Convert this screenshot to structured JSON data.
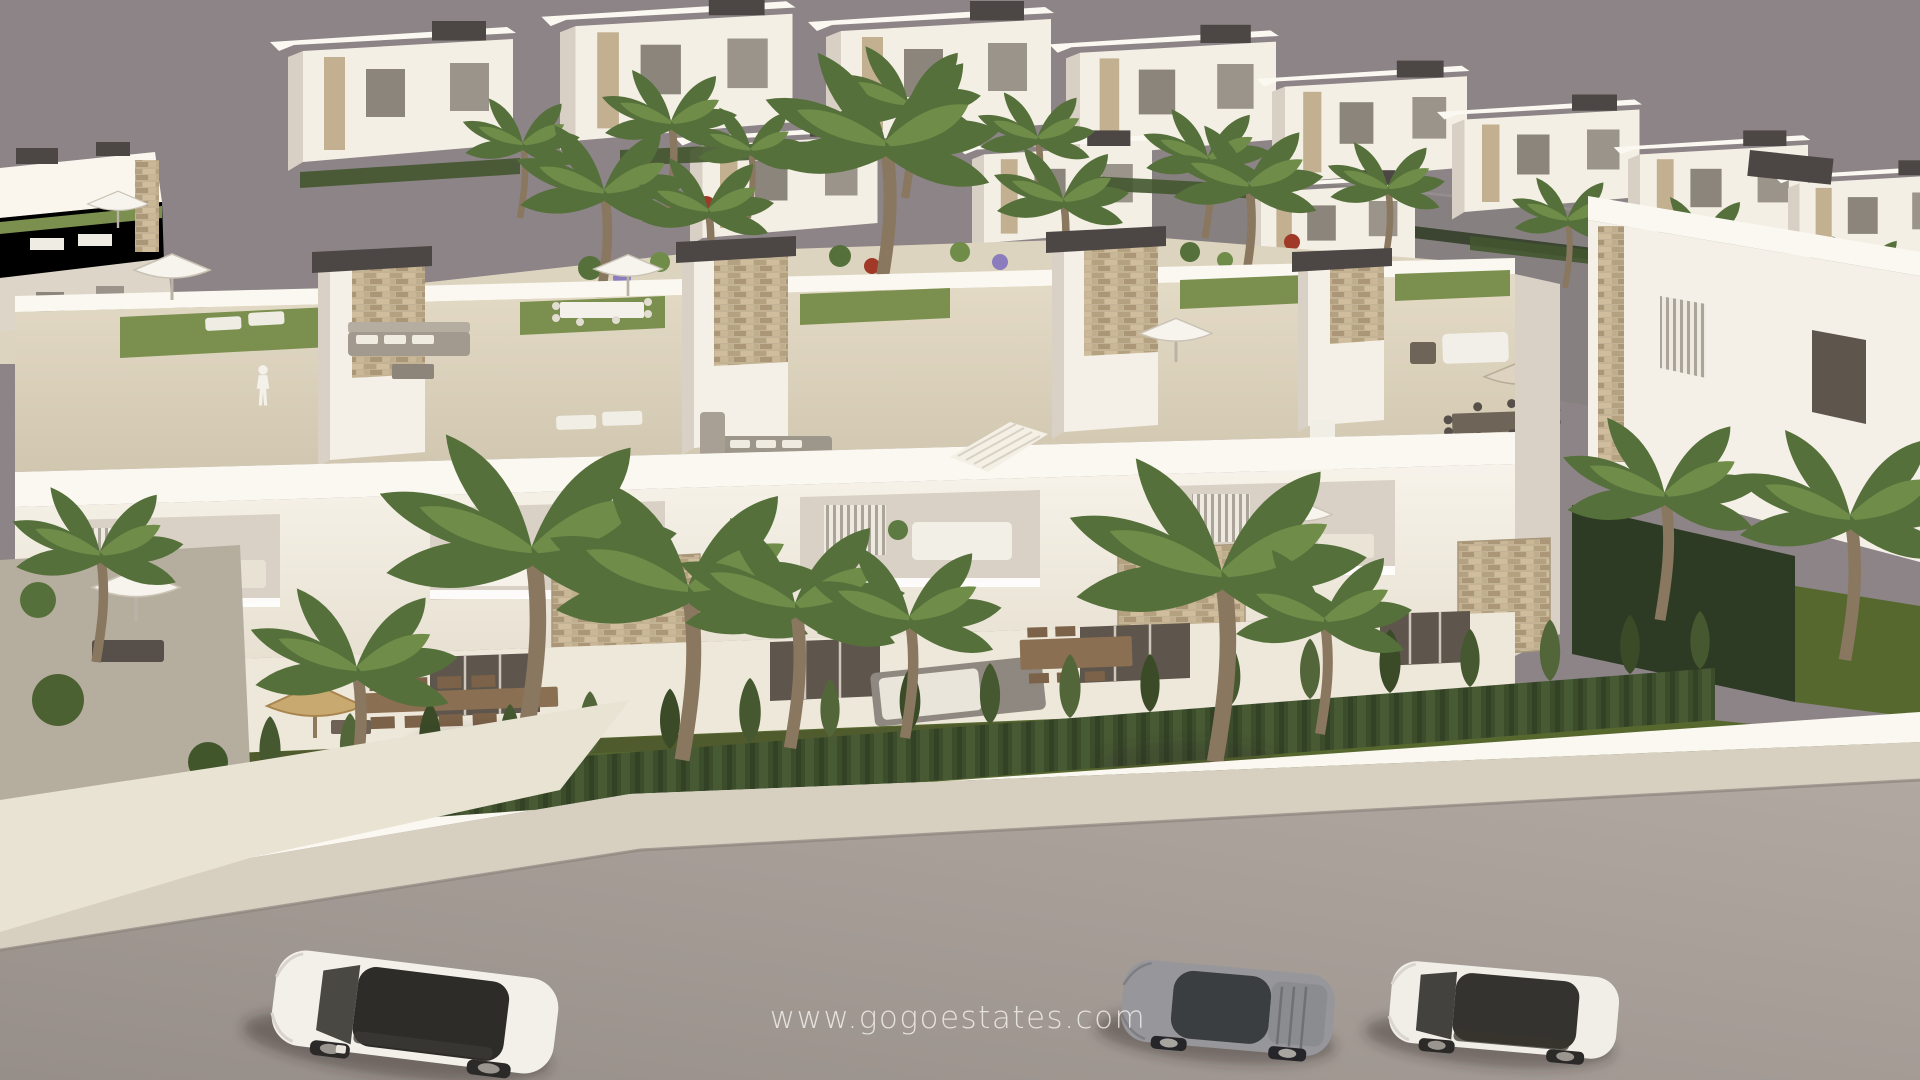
{
  "meta": {
    "description": "Aerial 3D architectural rendering of a new-build white apartment complex with rooftop terraces, palm gardens and a street with parked cars"
  },
  "watermark": {
    "text": "www.gogoestates.com",
    "color": "rgba(246,244,240,0.8)"
  },
  "palette": {
    "sky": "#8c8486",
    "horizon_ground": "#878081",
    "building_white": "#f5f0e7",
    "building_bright": "#fbf8f1",
    "building_shade": "#d9d1c5",
    "building_deep_shade": "#bcb4a7",
    "terrace_floor": "#e0d7c3",
    "roof_grass": "#7b8f4e",
    "lawn": "#57682f",
    "hedge": "#43552f",
    "hedge_dark": "#2e3b24",
    "palm_dark": "#55703a",
    "palm_light": "#6f8c49",
    "stone": "#c4b294",
    "pergola_dark": "#4c4744",
    "glass_dark": "#5e564c",
    "road": "#a9a19a",
    "sidewalk": "#d7cfc0",
    "driveway": "#e9e3d4",
    "gravel": "#b5ae9f",
    "shadow": "rgba(50,42,38,0.4)",
    "flower_purple": "#8b7cbe",
    "flower_red": "#a03927",
    "wood": "#8a6f52",
    "thatch": "#c8a96f"
  },
  "vehicles": [
    {
      "name": "white-suv",
      "body": "#f3f0ea",
      "glass": "#2e2c29"
    },
    {
      "name": "silver-sports-car",
      "body": "#97979b",
      "glass": "#3b3e41"
    },
    {
      "name": "white-sedan",
      "body": "#f1eee8",
      "glass": "#35332f"
    }
  ]
}
